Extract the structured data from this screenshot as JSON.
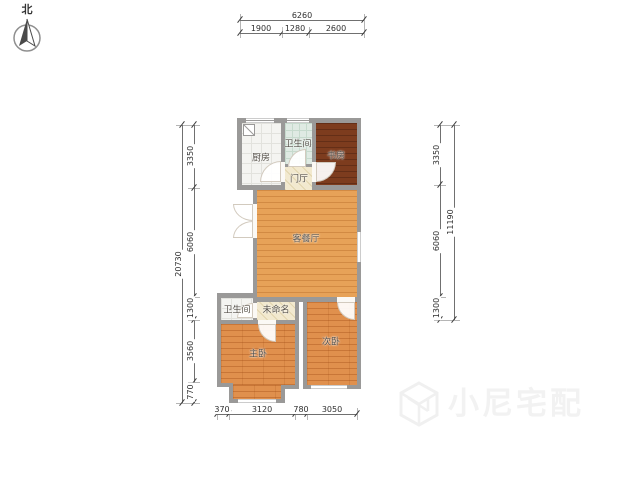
{
  "compass": {
    "label": "北"
  },
  "rooms": {
    "kitchen": {
      "label": "厨房"
    },
    "bath_upper": {
      "label": "卫生间"
    },
    "study": {
      "label": "书房"
    },
    "foyer": {
      "label": "门厅"
    },
    "living_dining": {
      "label": "客餐厅"
    },
    "bath_lower": {
      "label": "卫生间"
    },
    "unnamed": {
      "label": "未命名"
    },
    "master_bedroom": {
      "label": "主卧"
    },
    "second_bedroom": {
      "label": "次卧"
    }
  },
  "dims": {
    "top": {
      "overall": "6260",
      "segments": [
        "1900",
        "1280",
        "2600"
      ]
    },
    "left": {
      "overall": "20730",
      "segments": [
        "3350",
        "6060",
        "1300",
        "3560",
        "770"
      ]
    },
    "right": {
      "overall": "11190",
      "segments": [
        "3350",
        "6060",
        "1300"
      ]
    },
    "bottom": {
      "segments": [
        "370",
        "3120",
        "780",
        "3050"
      ]
    }
  },
  "watermark": {
    "brand": "小尼宅配",
    "logo": "cube-n-logo"
  },
  "colors": {
    "wall": "#9a9998",
    "wood_living": "#e7a258",
    "wood_bedroom": "#e0904d",
    "wood_study": "#7d3c1e",
    "tile_bath_mint": "#dfeae3",
    "tile_kitchen": "#f4f4f1",
    "tile_cream": "#f2e9cf",
    "dim_text": "#2e2e2e",
    "watermark_text": "#f2f2f2"
  }
}
